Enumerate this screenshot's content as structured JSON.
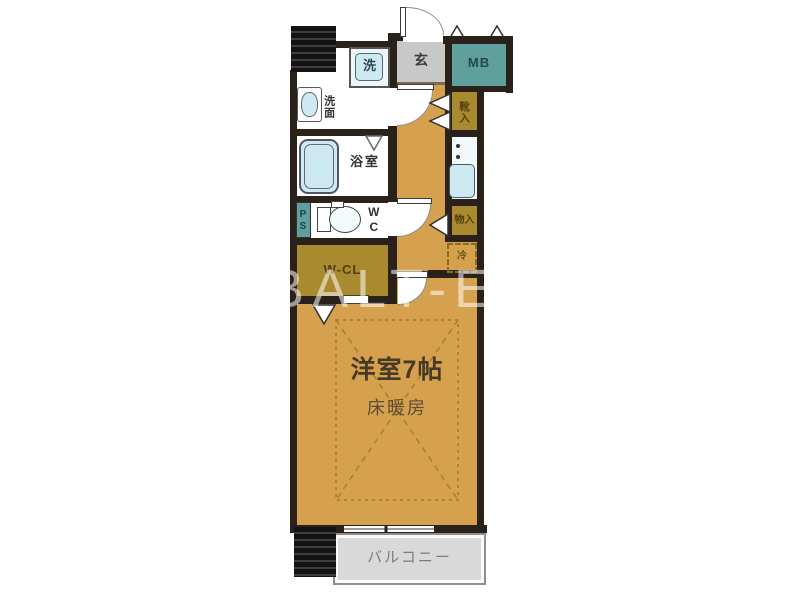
{
  "floorplan": {
    "watermark": "BALT-EST",
    "labels": {
      "entrance": "玄",
      "meter_box": "MB",
      "washer": "洗",
      "vanity": "洗面",
      "bathroom": "浴室",
      "toilet": "WC",
      "pipe_space": "PS",
      "walk_in_closet": "W-CL",
      "shoe_storage": "靴入",
      "storage": "物入",
      "fridge": "冷",
      "main_room": "洋室7帖",
      "floor_heating": "床暖房",
      "balcony": "バルコニー"
    },
    "colors": {
      "wall": "#2a211a",
      "tan": "#d5a14e",
      "mustard": "#a98a2e",
      "teal": "#5f9f9d",
      "genkan": "#c8c8c8",
      "balcony": "#d9d9d9",
      "cyan": "#cdeaf2",
      "dash": "#a8802a"
    }
  }
}
